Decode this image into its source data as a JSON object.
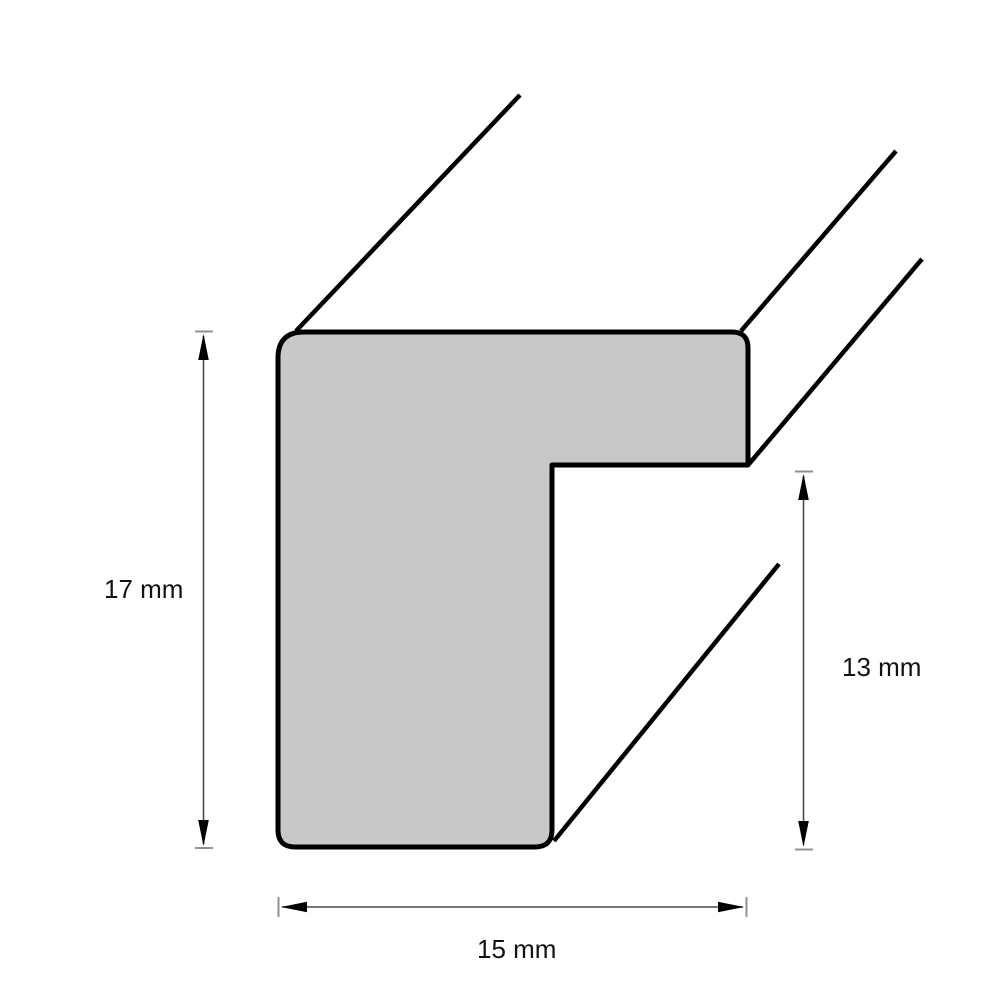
{
  "diagram": {
    "labels": {
      "height": "17 mm",
      "rabbet": "13 mm",
      "width": "15 mm"
    },
    "colors": {
      "profile_fill": "#c8c8c8",
      "outline": "#000000",
      "dimension_line": "#4a4a4a",
      "tick": "#8f8f8f",
      "label_text": "#111111",
      "background": "#ffffff"
    }
  }
}
